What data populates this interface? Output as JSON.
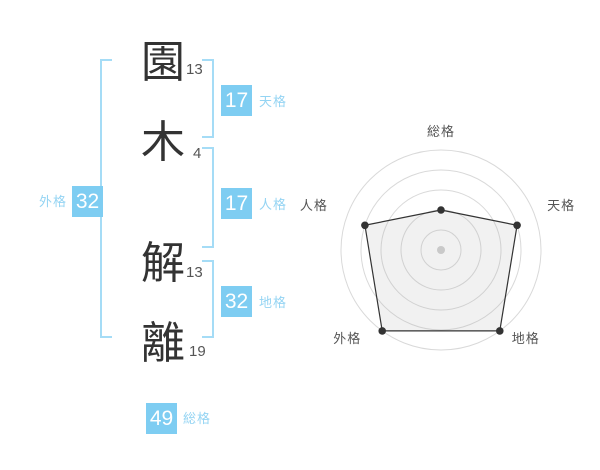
{
  "name_analysis": {
    "characters": [
      {
        "glyph": "園",
        "strokes": "13"
      },
      {
        "glyph": "木",
        "strokes": "4"
      },
      {
        "glyph": "解",
        "strokes": "13"
      },
      {
        "glyph": "離",
        "strokes": "19"
      }
    ],
    "tenkaku": {
      "value": "17",
      "label": "天格"
    },
    "jinkaku": {
      "value": "17",
      "label": "人格"
    },
    "chikaku": {
      "value": "32",
      "label": "地格"
    },
    "gaikaku": {
      "value": "32",
      "label": "外格"
    },
    "soukaku": {
      "value": "49",
      "label": "総格"
    }
  },
  "chart_data": {
    "type": "radar",
    "categories": [
      "総格",
      "天格",
      "地格",
      "外格",
      "人格"
    ],
    "values": [
      40,
      80,
      100,
      100,
      80
    ],
    "max": 100,
    "grid_rings": [
      20,
      40,
      60,
      80,
      100
    ],
    "grid": true,
    "legend_position": "none",
    "title": ""
  },
  "colors": {
    "accent_blue": "#7ecdf2",
    "label_blue": "#94d4f3",
    "bracket_blue": "#a5dcf6",
    "kanji_dark": "#333333",
    "text_gray": "#555555",
    "grid_gray": "#d9d9d9",
    "polygon_stroke": "#333333",
    "polygon_fill": "rgba(170,170,170,0.16)",
    "center_dot": "#c9c9c9"
  }
}
